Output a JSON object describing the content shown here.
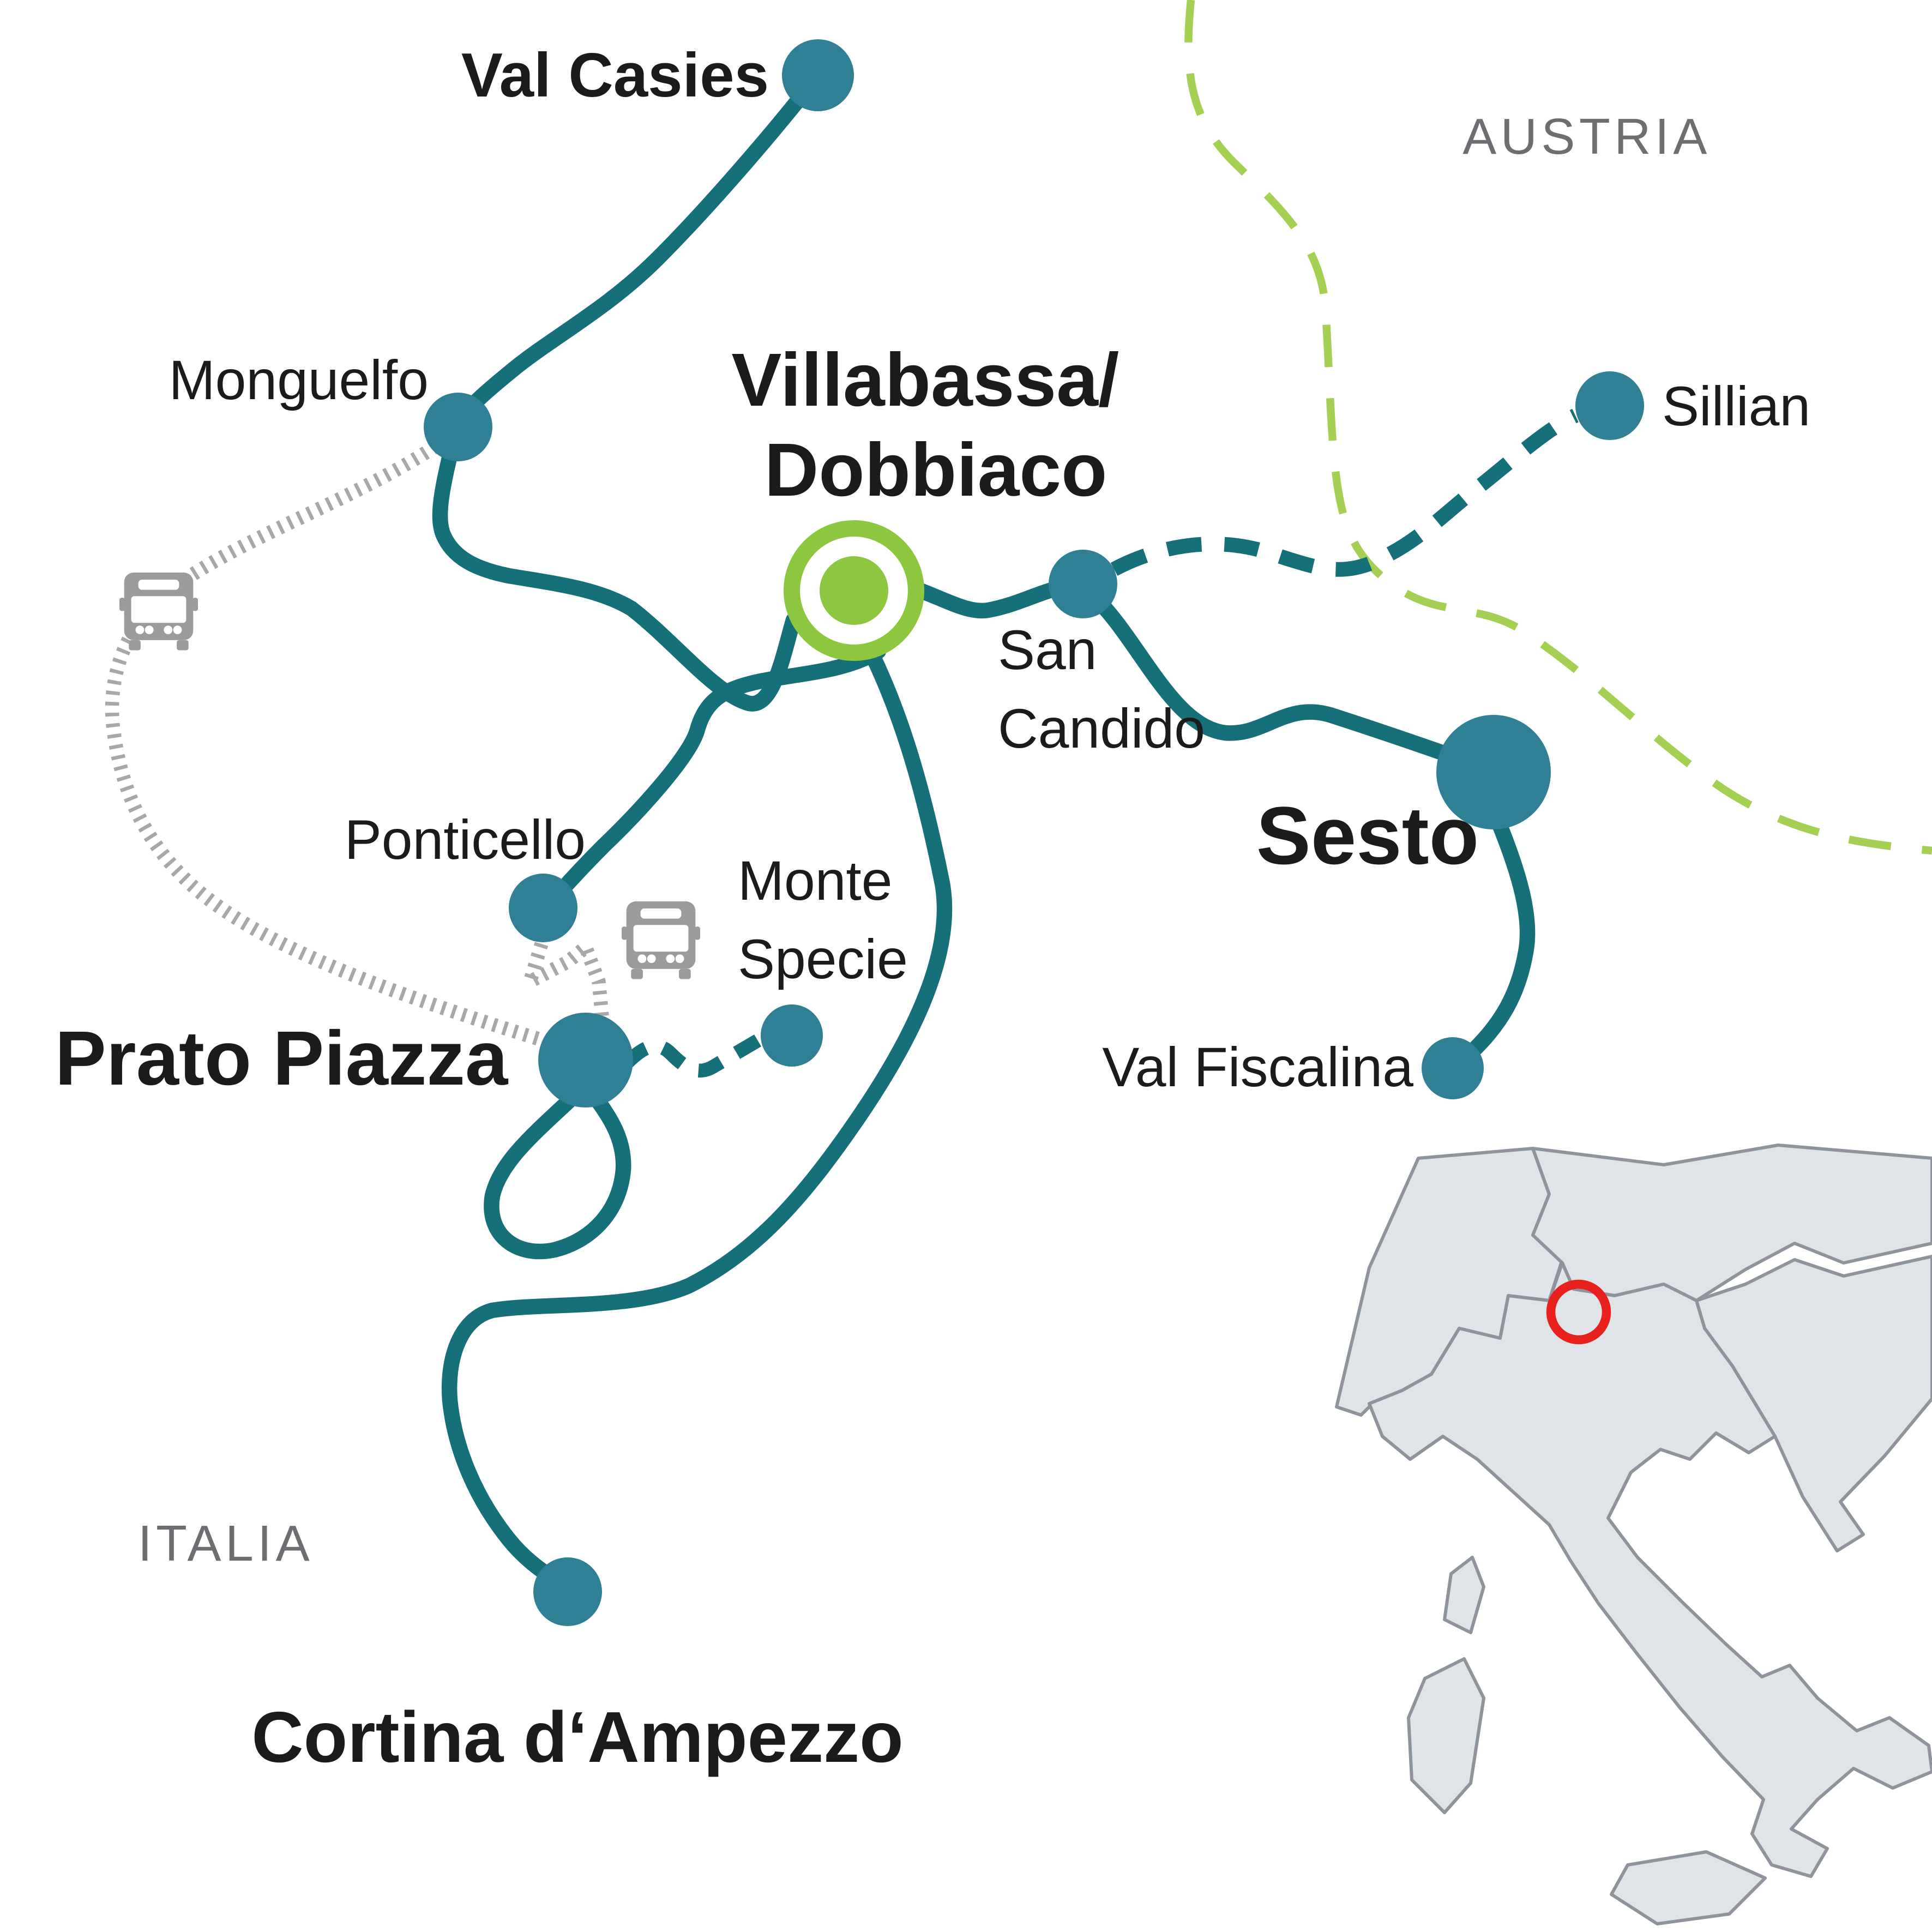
{
  "map_type": "schematic-route-map",
  "regions": {
    "austria": "AUSTRIA",
    "italia": "ITALIA"
  },
  "stations": [
    {
      "id": "val-casies",
      "label": "Val Casies",
      "emphasis": "bold",
      "marker": "dot"
    },
    {
      "id": "monguelfo",
      "label": "Monguelfo",
      "emphasis": "regular",
      "marker": "dot"
    },
    {
      "id": "villabassa-dobbiaco",
      "lines": [
        "Villabassa/",
        "Dobbiaco"
      ],
      "emphasis": "bold",
      "marker": "green-hub-ring"
    },
    {
      "id": "san-candido",
      "lines": [
        "San",
        "Candido"
      ],
      "emphasis": "regular",
      "marker": "dot"
    },
    {
      "id": "sillian",
      "label": "Sillian",
      "emphasis": "regular",
      "marker": "dot"
    },
    {
      "id": "sesto",
      "label": "Sesto",
      "emphasis": "bold",
      "marker": "large-dot"
    },
    {
      "id": "val-fiscalina",
      "label": "Val Fiscalina",
      "emphasis": "regular",
      "marker": "dot"
    },
    {
      "id": "ponticello",
      "label": "Ponticello",
      "emphasis": "regular",
      "marker": "dot"
    },
    {
      "id": "monte-specie",
      "lines": [
        "Monte",
        "Specie"
      ],
      "emphasis": "regular",
      "marker": "dot"
    },
    {
      "id": "prato-piazza",
      "label": "Prato Piazza",
      "emphasis": "bold",
      "marker": "large-dot"
    },
    {
      "id": "cortina-dampezzo",
      "label": "Cortina d‘Ampezzo",
      "emphasis": "bold",
      "marker": "dot"
    }
  ],
  "routes": [
    {
      "from": "Val Casies",
      "to": "Monguelfo",
      "style": "solid-teal"
    },
    {
      "from": "Monguelfo",
      "to": "Villabassa/Dobbiaco",
      "style": "solid-teal"
    },
    {
      "from": "Villabassa/Dobbiaco",
      "to": "San Candido",
      "style": "solid-teal"
    },
    {
      "from": "San Candido",
      "to": "Sesto",
      "style": "solid-teal"
    },
    {
      "from": "Sesto",
      "to": "Val Fiscalina",
      "style": "solid-teal"
    },
    {
      "from": "San Candido",
      "to": "Sillian",
      "style": "dashed-teal"
    },
    {
      "from": "Villabassa/Dobbiaco",
      "to": "Ponticello",
      "style": "solid-teal"
    },
    {
      "from": "Villabassa/Dobbiaco",
      "to": "Cortina d‘Ampezzo",
      "style": "solid-teal"
    },
    {
      "at": "Prato Piazza",
      "style": "solid-teal-loop"
    },
    {
      "from": "Prato Piazza",
      "to": "Monte Specie",
      "style": "dashed-teal"
    },
    {
      "from": "Monguelfo",
      "to": "Prato Piazza",
      "style": "gray-hatched-bus"
    },
    {
      "from": "Ponticello",
      "to": "Prato Piazza",
      "style": "gray-hatched-bus"
    },
    {
      "name": "country-border Austria/Italia",
      "style": "green-dashed"
    }
  ],
  "icons": {
    "bus_icon": "front-view bus pictogram",
    "red_ring_icon": "red circle marker on inset locator map"
  },
  "colors": {
    "line_teal": "#16707a",
    "dot_teal": "#2f8095",
    "hub_green": "#8dc63f",
    "border_green": "#a6d054",
    "bus_gray": "#9b9b9b",
    "hatch_gray": "#a8a8a8",
    "label_black": "#1b1b1b",
    "region_gray": "#6d6e71",
    "inset_fill": "#dfe4e9",
    "inset_stroke": "#8e939c",
    "inset_red": "#e8211f"
  }
}
